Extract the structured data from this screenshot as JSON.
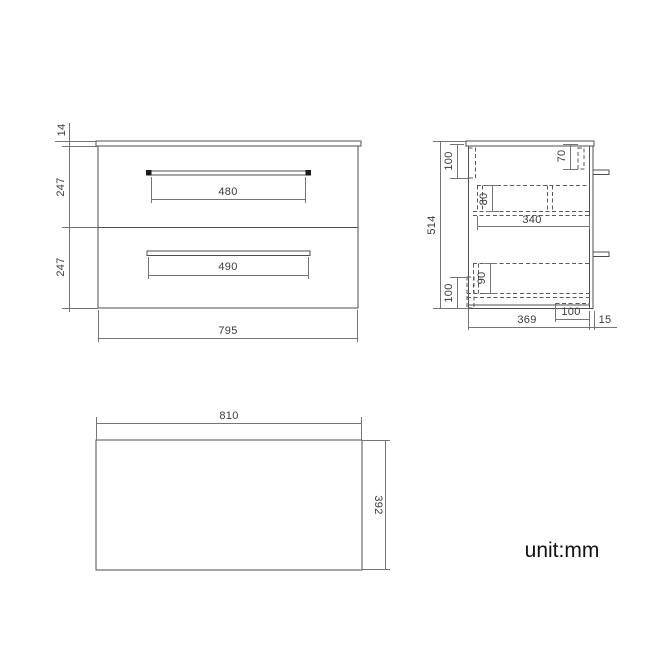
{
  "title": "vanity-unit-technical-drawing",
  "footer": {
    "unit_label": "unit:mm"
  },
  "front_view": {
    "overall_width": "795",
    "worktop_thickness": "14",
    "top_drawer_height": "247",
    "bottom_drawer_height": "247",
    "top_handle_width": "480",
    "bottom_handle_width": "490"
  },
  "side_view": {
    "overall_height": "514",
    "cabinet_depth": "369",
    "worktop_overhang": "15",
    "top_rail_height": "100",
    "bottom_rail_height": "100",
    "handle_drop_from_top": "70",
    "top_drawer_inner_height": "80",
    "bottom_drawer_inner_height": "90",
    "drawer_internal_depth": "340",
    "base_recess_depth": "100"
  },
  "top_view": {
    "overall_width": "810",
    "overall_depth": "392"
  },
  "colors": {
    "outline": "#4f4f4f",
    "dimension": "#757575",
    "text": "#3a3a3a",
    "background": "#ffffff"
  }
}
